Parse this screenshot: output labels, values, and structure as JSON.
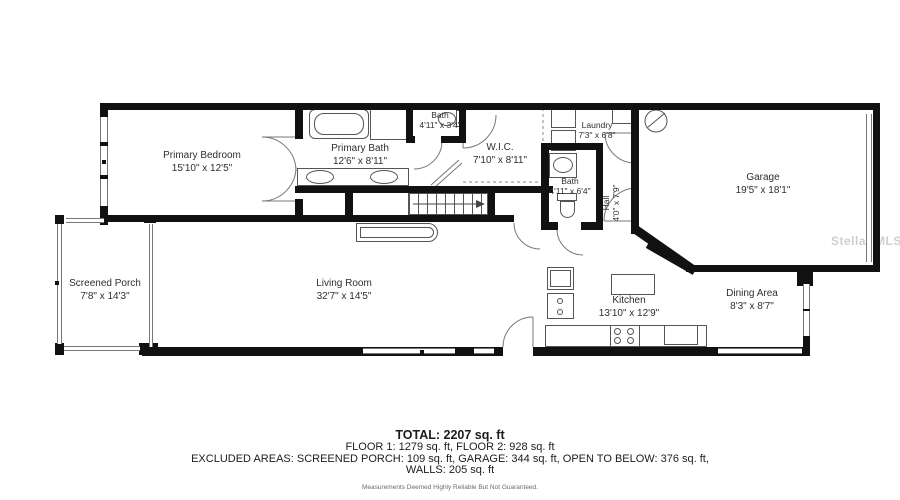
{
  "plan": {
    "watermark": "Stellar MLS",
    "colors": {
      "wall": "#111111",
      "thin_line": "#666666",
      "text": "#2e2e2e",
      "watermark": "#cfcfcf"
    },
    "icons": {
      "electrical-panel-icon": "circle-with-slash",
      "shower-icon": "boxed-x",
      "stairs-direction-arrow-icon": "right-arrow"
    },
    "rooms": [
      {
        "id": "primary-bedroom",
        "name": "Primary Bedroom",
        "dims": "15'10\" x 12'5\""
      },
      {
        "id": "primary-bath",
        "name": "Primary Bath",
        "dims": "12'6\" x 8'11\""
      },
      {
        "id": "bath-upper",
        "name": "Bath",
        "dims": "4'11\" x 3'4\""
      },
      {
        "id": "wic",
        "name": "W.I.C.",
        "dims": "7'10\" x 8'11\""
      },
      {
        "id": "laundry",
        "name": "Laundry",
        "dims": "7'3\" x 6'8\""
      },
      {
        "id": "bath-hall",
        "name": "Bath",
        "dims": "4'11\" x 6'4\""
      },
      {
        "id": "hall",
        "name": "Hall",
        "dims": "4'0\" x 7'9\""
      },
      {
        "id": "garage",
        "name": "Garage",
        "dims": "19'5\" x 18'1\""
      },
      {
        "id": "screened-porch",
        "name": "Screened Porch",
        "dims": "7'8\" x 14'3\""
      },
      {
        "id": "living-room",
        "name": "Living Room",
        "dims": "32'7\" x 14'5\""
      },
      {
        "id": "kitchen",
        "name": "Kitchen",
        "dims": "13'10\" x 12'9\""
      },
      {
        "id": "dining-area",
        "name": "Dining Area",
        "dims": "8'3\" x 8'7\""
      }
    ],
    "summary": {
      "total": "TOTAL: 2207 sq. ft",
      "floors": "FLOOR 1: 1279 sq. ft, FLOOR 2: 928 sq. ft",
      "excluded": "EXCLUDED AREAS: SCREENED PORCH: 109 sq. ft, GARAGE: 344 sq. ft, OPEN TO BELOW: 376 sq. ft,",
      "walls": "WALLS: 205 sq. ft",
      "disclaimer": "Measurements Deemed Highly Reliable But Not Guaranteed."
    }
  }
}
